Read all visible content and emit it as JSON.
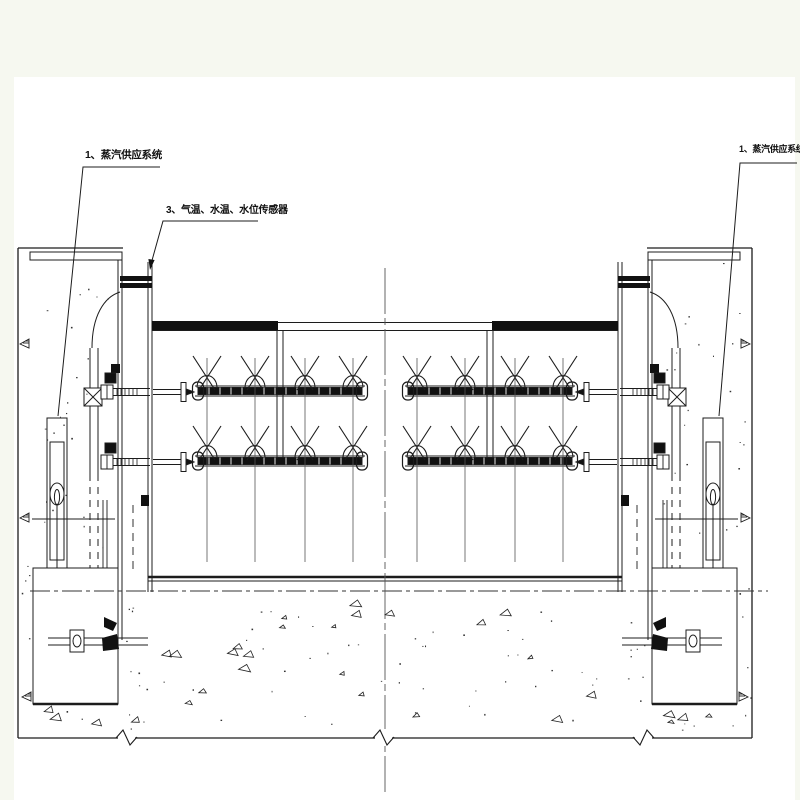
{
  "page": {
    "background": "#f6f8f0",
    "paper": "#ffffff",
    "line_color": "#1c1c1c",
    "thin_line_color": "#555555"
  },
  "labels": {
    "steam_supply_left": "1、蒸汽供应系统",
    "sensors": "3、气温、水温、水位传感器",
    "steam_supply_right": "1、蒸汽供应系统"
  }
}
